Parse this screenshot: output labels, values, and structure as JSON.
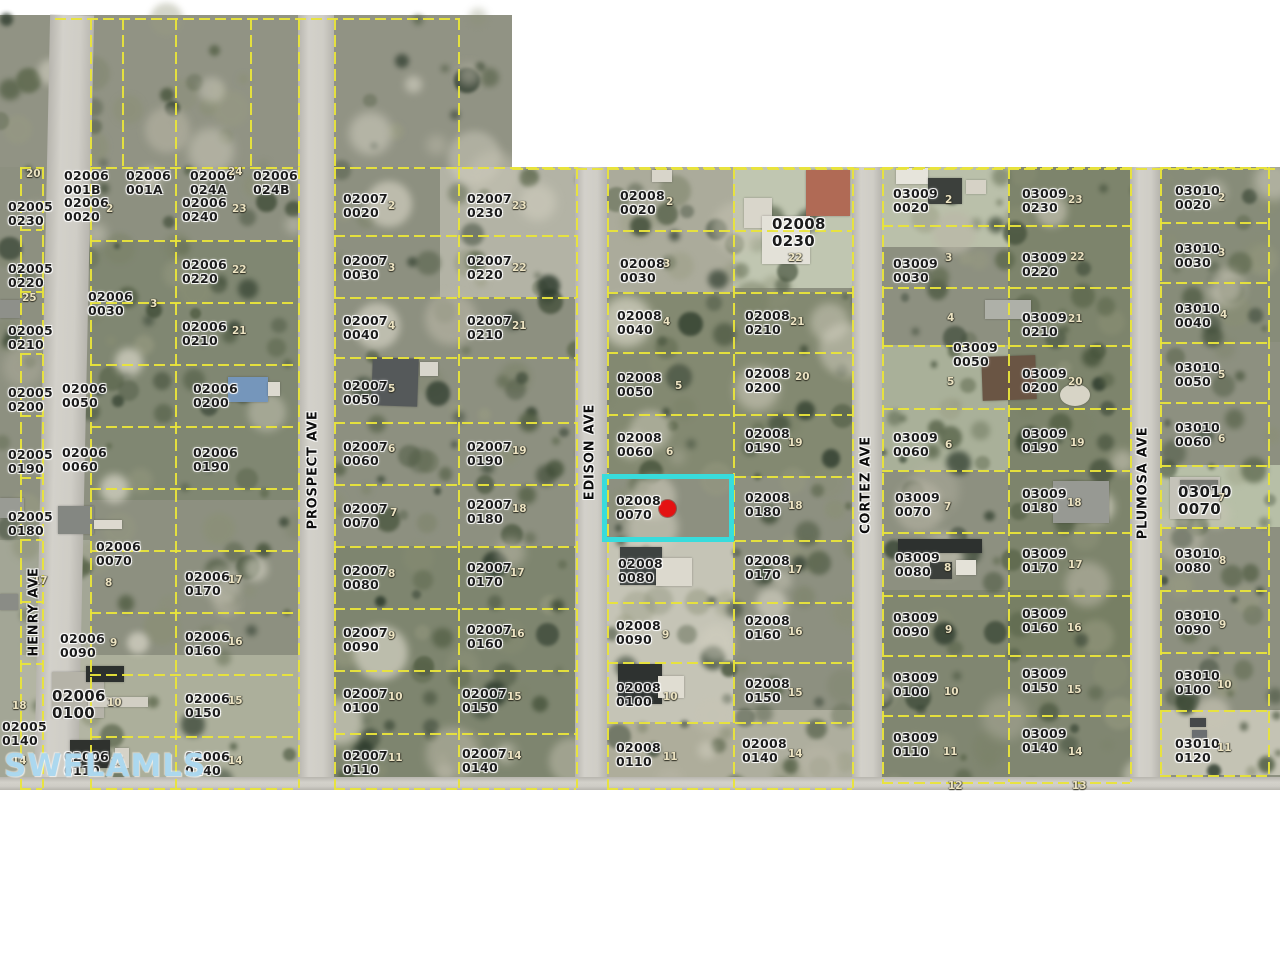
{
  "watermark": "SWFLAMLS",
  "colors": {
    "boundary_line": "#e9e43a",
    "highlight": "#38dcdc",
    "subject_marker": "#e41212",
    "road": "#c9c7c0",
    "watermark": "#a8d6ee"
  },
  "highlight": {
    "parcel": "02008 0070",
    "x": 602,
    "y": 474,
    "w": 132,
    "h": 68,
    "dot": {
      "x": 667,
      "y": 508,
      "d": 17
    }
  },
  "streets": [
    {
      "name": "HENRY AVE",
      "x": 34,
      "y": 612
    },
    {
      "name": "PROSPECT AVE",
      "x": 313,
      "y": 470
    },
    {
      "name": "EDISON AVE",
      "x": 590,
      "y": 452
    },
    {
      "name": "CORTEZ AVE",
      "x": 866,
      "y": 485
    },
    {
      "name": "PLUMOSA AVE",
      "x": 1143,
      "y": 483
    }
  ],
  "roads": [
    {
      "name": "henry-ave-road",
      "x": 42,
      "y": 15,
      "w": 44,
      "h": 775,
      "rot": 1.2,
      "dir": "v"
    },
    {
      "name": "prospect-ave-road",
      "x": 298,
      "y": 15,
      "w": 36,
      "h": 775,
      "rot": 0,
      "dir": "v"
    },
    {
      "name": "edison-ave-road",
      "x": 575,
      "y": 167,
      "w": 32,
      "h": 623,
      "rot": 0,
      "dir": "v"
    },
    {
      "name": "cortez-ave-road",
      "x": 852,
      "y": 167,
      "w": 30,
      "h": 623,
      "rot": 0,
      "dir": "v"
    },
    {
      "name": "plumosa-ave-road",
      "x": 1130,
      "y": 167,
      "w": 30,
      "h": 623,
      "rot": 0,
      "dir": "v"
    },
    {
      "name": "cross-street-road",
      "x": 0,
      "y": 777,
      "w": 1280,
      "h": 13,
      "rot": 0,
      "dir": "h"
    }
  ],
  "parcel_labels": [
    [
      "02005 0230",
      8,
      200
    ],
    [
      "02005 0220",
      8,
      262
    ],
    [
      "02005 0210",
      8,
      324
    ],
    [
      "02005 0200",
      8,
      386
    ],
    [
      "02005 0190",
      8,
      448
    ],
    [
      "02005 0180",
      8,
      510
    ],
    [
      "02005 0140",
      2,
      720
    ],
    [
      "02006 001B",
      64,
      169
    ],
    [
      "02006 001A",
      126,
      169
    ],
    [
      "02006 024A",
      190,
      169
    ],
    [
      "02006 024B",
      253,
      169
    ],
    [
      "02006 0020",
      64,
      196
    ],
    [
      "02006 0240",
      182,
      196
    ],
    [
      "02006 0030",
      88,
      290
    ],
    [
      "02006 0220",
      182,
      258
    ],
    [
      "02006 0210",
      182,
      320
    ],
    [
      "02006 0050",
      62,
      382
    ],
    [
      "02006 0200",
      193,
      382
    ],
    [
      "02006 0060",
      62,
      446
    ],
    [
      "02006 0190",
      193,
      446
    ],
    [
      "02006 0070",
      96,
      540
    ],
    [
      "02006 0170",
      185,
      570
    ],
    [
      "02006 0090",
      60,
      632
    ],
    [
      "02006 0160",
      185,
      630
    ],
    [
      "02006 0100",
      52,
      688,
      1
    ],
    [
      "02006 0150",
      185,
      692
    ],
    [
      "02006 0110",
      64,
      750
    ],
    [
      "02006 0140",
      185,
      750
    ],
    [
      "02007 0020",
      343,
      192
    ],
    [
      "02007 0230",
      467,
      192
    ],
    [
      "02007 0030",
      343,
      254
    ],
    [
      "02007 0220",
      467,
      254
    ],
    [
      "02007 0040",
      343,
      314
    ],
    [
      "02007 0210",
      467,
      314
    ],
    [
      "02007 0050",
      343,
      379
    ],
    [
      "02007 0060",
      343,
      440
    ],
    [
      "02007 0190",
      467,
      440
    ],
    [
      "02007 0070",
      343,
      502
    ],
    [
      "02007 0180",
      467,
      498
    ],
    [
      "02007 0080",
      343,
      564
    ],
    [
      "02007 0170",
      467,
      561
    ],
    [
      "02007 0090",
      343,
      626
    ],
    [
      "02007 0160",
      467,
      623
    ],
    [
      "02007 0100",
      343,
      687
    ],
    [
      "02007 0150",
      462,
      687
    ],
    [
      "02007 0110",
      343,
      749
    ],
    [
      "02007 0140",
      462,
      747
    ],
    [
      "02008 0020",
      620,
      189
    ],
    [
      "02008 0230",
      772,
      216,
      1
    ],
    [
      "02008 0030",
      620,
      257
    ],
    [
      "02008 0040",
      617,
      309
    ],
    [
      "02008 0210",
      745,
      309
    ],
    [
      "02008 0050",
      617,
      371
    ],
    [
      "02008 0200",
      745,
      367
    ],
    [
      "02008 0060",
      617,
      431
    ],
    [
      "02008 0190",
      745,
      427
    ],
    [
      "02008 0070",
      616,
      494
    ],
    [
      "02008 0180",
      745,
      491
    ],
    [
      "02008 0080",
      618,
      557
    ],
    [
      "02008 0170",
      745,
      554
    ],
    [
      "02008 0090",
      616,
      619
    ],
    [
      "02008 0160",
      745,
      614
    ],
    [
      "02008 0100",
      616,
      681
    ],
    [
      "02008 0150",
      745,
      677
    ],
    [
      "02008 0110",
      616,
      741
    ],
    [
      "02008 0140",
      742,
      737
    ],
    [
      "03009 0020",
      893,
      187
    ],
    [
      "03009 0230",
      1022,
      187
    ],
    [
      "03009 0030",
      893,
      257
    ],
    [
      "03009 0220",
      1022,
      251
    ],
    [
      "03009 0210",
      1022,
      311
    ],
    [
      "03009 0050",
      953,
      341
    ],
    [
      "03009 0200",
      1022,
      367
    ],
    [
      "03009 0060",
      893,
      431
    ],
    [
      "03009 0190",
      1022,
      427
    ],
    [
      "03009 0070",
      895,
      491
    ],
    [
      "03009 0180",
      1022,
      487
    ],
    [
      "03009 0080",
      895,
      551
    ],
    [
      "03009 0170",
      1022,
      547
    ],
    [
      "03009 0090",
      893,
      611
    ],
    [
      "03009 0160",
      1022,
      607
    ],
    [
      "03009 0100",
      893,
      671
    ],
    [
      "03009 0150",
      1022,
      667
    ],
    [
      "03009 0110",
      893,
      731
    ],
    [
      "03009 0140",
      1022,
      727
    ],
    [
      "03010 0020",
      1175,
      184
    ],
    [
      "03010 0030",
      1175,
      242
    ],
    [
      "03010 0040",
      1175,
      302
    ],
    [
      "03010 0050",
      1175,
      361
    ],
    [
      "03010 0060",
      1175,
      421
    ],
    [
      "03010 0070",
      1178,
      484,
      1
    ],
    [
      "03010 0080",
      1175,
      547
    ],
    [
      "03010 0090",
      1175,
      609
    ],
    [
      "03010 0100",
      1175,
      669
    ],
    [
      "03010 0120",
      1175,
      737
    ]
  ],
  "lot_markers": [
    [
      "20",
      26,
      168
    ],
    [
      "25",
      22,
      292
    ],
    [
      "17",
      33,
      575
    ],
    [
      "18",
      12,
      700
    ],
    [
      "14",
      12,
      755
    ],
    [
      "2",
      106,
      203
    ],
    [
      "24",
      228,
      166
    ],
    [
      "23",
      232,
      203
    ],
    [
      "22",
      232,
      264
    ],
    [
      "3",
      150,
      298
    ],
    [
      "21",
      232,
      325
    ],
    [
      "8",
      105,
      577
    ],
    [
      "17",
      228,
      574
    ],
    [
      "9",
      110,
      637
    ],
    [
      "16",
      228,
      636
    ],
    [
      "10",
      107,
      697
    ],
    [
      "15",
      228,
      695
    ],
    [
      "11",
      110,
      756
    ],
    [
      "14",
      228,
      755
    ],
    [
      "2",
      388,
      200
    ],
    [
      "23",
      512,
      200
    ],
    [
      "3",
      388,
      262
    ],
    [
      "22",
      512,
      262
    ],
    [
      "4",
      388,
      320
    ],
    [
      "21",
      512,
      320
    ],
    [
      "5",
      388,
      383
    ],
    [
      "6",
      388,
      443
    ],
    [
      "19",
      512,
      445
    ],
    [
      "7",
      390,
      507
    ],
    [
      "18",
      512,
      503
    ],
    [
      "8",
      388,
      568
    ],
    [
      "17",
      510,
      567
    ],
    [
      "9",
      388,
      630
    ],
    [
      "16",
      510,
      628
    ],
    [
      "10",
      388,
      691
    ],
    [
      "15",
      507,
      691
    ],
    [
      "11",
      388,
      752
    ],
    [
      "14",
      507,
      750
    ],
    [
      "2",
      666,
      196
    ],
    [
      "3",
      663,
      258
    ],
    [
      "4",
      663,
      316
    ],
    [
      "5",
      675,
      380
    ],
    [
      "6",
      666,
      446
    ],
    [
      "22",
      788,
      252
    ],
    [
      "21",
      790,
      316
    ],
    [
      "20",
      795,
      371
    ],
    [
      "19",
      788,
      437
    ],
    [
      "18",
      788,
      500
    ],
    [
      "17",
      788,
      564
    ],
    [
      "16",
      788,
      626
    ],
    [
      "15",
      788,
      687
    ],
    [
      "14",
      788,
      748
    ],
    [
      "9",
      662,
      629
    ],
    [
      "10",
      663,
      691
    ],
    [
      "11",
      663,
      751
    ],
    [
      "2",
      945,
      194
    ],
    [
      "3",
      945,
      252
    ],
    [
      "4",
      947,
      312
    ],
    [
      "5",
      947,
      376
    ],
    [
      "6",
      945,
      439
    ],
    [
      "7",
      944,
      501
    ],
    [
      "8",
      944,
      562
    ],
    [
      "9",
      945,
      624
    ],
    [
      "10",
      944,
      686
    ],
    [
      "11",
      943,
      746
    ],
    [
      "23",
      1068,
      194
    ],
    [
      "22",
      1070,
      251
    ],
    [
      "21",
      1068,
      313
    ],
    [
      "20",
      1068,
      376
    ],
    [
      "19",
      1070,
      437
    ],
    [
      "18",
      1067,
      497
    ],
    [
      "17",
      1068,
      559
    ],
    [
      "16",
      1067,
      622
    ],
    [
      "15",
      1067,
      684
    ],
    [
      "14",
      1068,
      746
    ],
    [
      "12",
      948,
      780
    ],
    [
      "13",
      1072,
      780
    ],
    [
      "2",
      1218,
      192
    ],
    [
      "3",
      1218,
      247
    ],
    [
      "4",
      1220,
      309
    ],
    [
      "5",
      1218,
      369
    ],
    [
      "6",
      1218,
      433
    ],
    [
      "7",
      1218,
      492
    ],
    [
      "8",
      1219,
      555
    ],
    [
      "9",
      1219,
      619
    ],
    [
      "10",
      1217,
      679
    ],
    [
      "11",
      1217,
      742
    ]
  ],
  "grid": {
    "blocks": [
      {
        "x1": 20,
        "xm": null,
        "x2": 42,
        "rows": [
          167,
          229,
          291,
          353,
          415,
          477,
          539,
          601,
          663,
          725,
          788
        ]
      },
      {
        "x1": 90,
        "xm": 175,
        "x2": 298,
        "rows": [
          167,
          240,
          302,
          364,
          426,
          488,
          550,
          612,
          674,
          736,
          788
        ]
      },
      {
        "x1": 334,
        "xm": 458,
        "x2": 576,
        "rows": [
          167,
          235,
          297,
          357,
          422,
          484,
          546,
          608,
          670,
          733,
          788
        ]
      },
      {
        "x1": 607,
        "xm": 733,
        "x2": 852,
        "rows": [
          167,
          230,
          292,
          352,
          414,
          476,
          540,
          602,
          662,
          722,
          788
        ]
      },
      {
        "x1": 882,
        "xm": 1008,
        "x2": 1130,
        "rows": [
          167,
          225,
          287,
          345,
          408,
          470,
          532,
          595,
          655,
          715,
          782
        ]
      },
      {
        "x1": 1160,
        "xm": null,
        "x2": 1268,
        "rows": [
          167,
          222,
          282,
          342,
          402,
          465,
          527,
          590,
          652,
          710,
          775
        ]
      }
    ],
    "extra_v": [
      [
        90,
        18,
        167
      ],
      [
        122,
        18,
        167
      ],
      [
        175,
        18,
        167
      ],
      [
        250,
        18,
        167
      ],
      [
        298,
        18,
        167
      ],
      [
        334,
        18,
        167
      ],
      [
        458,
        18,
        167
      ]
    ],
    "extra_h": [
      [
        18,
        55,
        460
      ],
      [
        168,
        512,
        1280
      ]
    ]
  },
  "buildings": [
    [
      228,
      377,
      40,
      25,
      "#7596bb",
      0,
      0
    ],
    [
      268,
      382,
      12,
      14,
      "#dcd9cf",
      0,
      0
    ],
    [
      372,
      358,
      46,
      48,
      "#55595a",
      2,
      0
    ],
    [
      420,
      362,
      18,
      14,
      "#d8d6cc",
      0,
      0
    ],
    [
      58,
      506,
      36,
      28,
      "#848782",
      0,
      0
    ],
    [
      94,
      520,
      28,
      9,
      "#ddd9cf",
      0,
      0
    ],
    [
      52,
      672,
      52,
      46,
      "#b5b3a8",
      0,
      0
    ],
    [
      86,
      666,
      38,
      16,
      "#2c302e",
      0,
      0
    ],
    [
      70,
      740,
      40,
      28,
      "#2f322e",
      0,
      0
    ],
    [
      115,
      748,
      14,
      20,
      "#d6d3c8",
      0,
      0
    ],
    [
      744,
      198,
      28,
      30,
      "#d9d6cb",
      0,
      0
    ],
    [
      806,
      170,
      44,
      46,
      "#b06a55",
      0,
      0
    ],
    [
      762,
      216,
      48,
      48,
      "#e3e1d8",
      0,
      0
    ],
    [
      652,
      170,
      20,
      12,
      "#d8d5ca",
      0,
      0
    ],
    [
      896,
      168,
      32,
      16,
      "#e6e4db",
      0,
      0
    ],
    [
      928,
      178,
      34,
      26,
      "#3c403c",
      0,
      0
    ],
    [
      966,
      180,
      20,
      14,
      "#d6d2c6",
      0,
      0
    ],
    [
      985,
      300,
      46,
      19,
      "#aeb0a8",
      0,
      0
    ],
    [
      982,
      356,
      54,
      44,
      "#6a5544",
      -2,
      0
    ],
    [
      1060,
      384,
      30,
      22,
      "#d7d4c6",
      0,
      1
    ],
    [
      1053,
      481,
      56,
      42,
      "#979993",
      0,
      0
    ],
    [
      898,
      539,
      84,
      14,
      "#2d312f",
      0,
      0
    ],
    [
      930,
      562,
      22,
      17,
      "#3b3f3b",
      0,
      0
    ],
    [
      956,
      560,
      20,
      15,
      "#e4e2d8",
      0,
      0
    ],
    [
      620,
      547,
      42,
      38,
      "#3e4341",
      0,
      0
    ],
    [
      656,
      558,
      36,
      28,
      "#dcd9ce",
      0,
      0
    ],
    [
      618,
      664,
      44,
      40,
      "#2e3230",
      0,
      0
    ],
    [
      658,
      676,
      26,
      22,
      "#e0ddd2",
      0,
      0
    ],
    [
      1170,
      477,
      50,
      42,
      "#c5c3b9",
      0,
      0
    ],
    [
      1180,
      480,
      38,
      10,
      "#767872",
      0,
      0
    ],
    [
      1190,
      718,
      16,
      9,
      "#45484a",
      0,
      0
    ],
    [
      1192,
      730,
      15,
      8,
      "#6a6e70",
      0,
      0
    ],
    [
      0,
      300,
      20,
      18,
      "#8e908a",
      0,
      0
    ],
    [
      0,
      498,
      24,
      20,
      "#999b94",
      0,
      0
    ],
    [
      0,
      594,
      18,
      16,
      "#8a8c86",
      0,
      0
    ],
    [
      88,
      697,
      60,
      10,
      "#d2cfc4",
      0,
      0
    ]
  ]
}
